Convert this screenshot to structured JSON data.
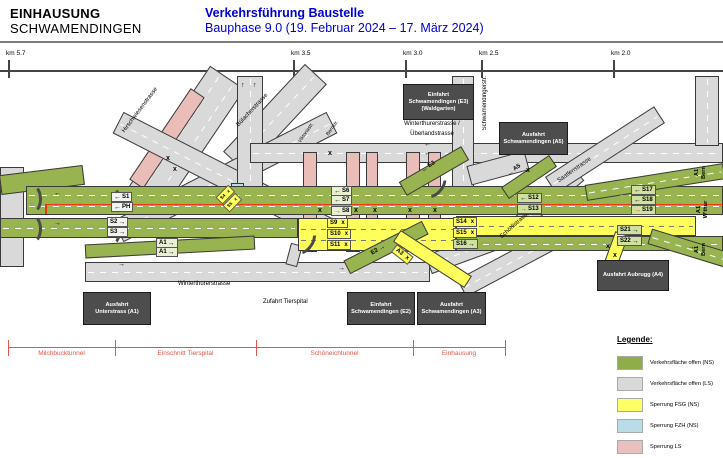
{
  "header": {
    "title_line1": "EINHAUSUNG",
    "title_line2": "SCHWAMENDINGEN",
    "subtitle_line1": "Verkehrsführung Baustelle",
    "subtitle_line2": "Bauphase 9.0 (19. Februar 2024 – 17. März 2024)",
    "accent_color": "#0000d2"
  },
  "km_scale": {
    "ticks": [
      {
        "label": "km 5.7",
        "x": 8
      },
      {
        "label": "km 3.5",
        "x": 293
      },
      {
        "label": "km 3.0",
        "x": 405
      },
      {
        "label": "km 2.5",
        "x": 481
      },
      {
        "label": "km 2.0",
        "x": 613
      }
    ]
  },
  "diagram": {
    "street_labels": [
      {
        "text": "Hirschwiesenstrasse",
        "x": 126,
        "y": 128,
        "rot": -53
      },
      {
        "text": "Bülacherstrasse",
        "x": 240,
        "y": 122,
        "rot": -47
      },
      {
        "text": "Viktoriastr.",
        "x": 302,
        "y": 138,
        "rot": -55,
        "fs": 5
      },
      {
        "text": "Bernstr.",
        "x": 330,
        "y": 131,
        "rot": -55,
        "fs": 5
      },
      {
        "text": "Winterthurerstrasse /",
        "x": 432,
        "y": 121,
        "rot": 0,
        "center": true
      },
      {
        "text": "Überlandstrasse",
        "x": 432,
        "y": 131,
        "rot": 0,
        "center": true
      },
      {
        "text": "Schörlistrasse",
        "x": 503,
        "y": 234,
        "rot": -42
      },
      {
        "text": "Saatlenstrasse",
        "x": 560,
        "y": 178,
        "rot": -35
      },
      {
        "text": "Winterthurerstrasse",
        "x": 178,
        "y": 281,
        "rot": 0
      },
      {
        "text": "Zufahrt Tierspital",
        "x": 263,
        "y": 299,
        "rot": 0
      }
    ],
    "vertical_street_label": {
      "text": "Schwamendingerstr.",
      "x": 482,
      "y": 76
    },
    "signal_chips": [
      {
        "t": "S1",
        "arrow": "left",
        "x": 111,
        "y": 192,
        "bg": "#f2f2ee"
      },
      {
        "t": "PH",
        "arrow": "left",
        "x": 111,
        "y": 202,
        "bg": "#f2f2ee"
      },
      {
        "t": "S2",
        "arrow": "right",
        "after": true,
        "x": 107,
        "y": 217,
        "bg": "#f2f2ee"
      },
      {
        "t": "S3",
        "arrow": "right",
        "after": true,
        "x": 107,
        "y": 227,
        "bg": "#f2f2ee"
      },
      {
        "t": "A1",
        "arrow": "right",
        "after": true,
        "x": 156,
        "y": 238,
        "bg": "#e8efd2"
      },
      {
        "t": "A1",
        "arrow": "right",
        "after": true,
        "x": 156,
        "y": 247,
        "bg": "#e8efd2"
      },
      {
        "t": "S6",
        "arrow": "left",
        "x": 331,
        "y": 186,
        "bg": "#e8efd2"
      },
      {
        "t": "S7",
        "arrow": "left",
        "x": 331,
        "y": 195,
        "bg": "#e8efd2"
      },
      {
        "t": "S8",
        "arrow": "rightred",
        "x": 331,
        "y": 206,
        "bg": "#e8efd2"
      },
      {
        "t": "S9",
        "suffix": "x",
        "x": 327,
        "y": 218,
        "bg": "#ffff5c"
      },
      {
        "t": "S10",
        "suffix": "x",
        "x": 327,
        "y": 229,
        "bg": "#ffff5c"
      },
      {
        "t": "S11",
        "suffix": "x",
        "x": 327,
        "y": 240,
        "bg": "#ffff5c"
      },
      {
        "t": "S14",
        "suffix": "x",
        "x": 453,
        "y": 217,
        "bg": "#ffff5c"
      },
      {
        "t": "S15",
        "suffix": "x",
        "x": 453,
        "y": 228,
        "bg": "#ffff5c"
      },
      {
        "t": "S16",
        "arrow": "right",
        "after": true,
        "x": 453,
        "y": 239,
        "bg": "#cfe0a0"
      },
      {
        "t": "S12",
        "arrow": "left",
        "x": 517,
        "y": 193,
        "bg": "#cfe0a0"
      },
      {
        "t": "S13",
        "arrow": "rightred",
        "x": 517,
        "y": 204,
        "bg": "#cfe0a0"
      },
      {
        "t": "S17",
        "arrow": "left",
        "x": 631,
        "y": 185,
        "bg": "#cfe0a0"
      },
      {
        "t": "S18",
        "arrow": "left",
        "x": 631,
        "y": 195,
        "bg": "#cfe0a0"
      },
      {
        "t": "S19",
        "arrow": "rightred",
        "x": 631,
        "y": 205,
        "bg": "#cfe0a0"
      },
      {
        "t": "S21",
        "arrow": "right",
        "after": true,
        "x": 617,
        "y": 225,
        "bg": "#cfe0a0"
      },
      {
        "t": "S22",
        "arrow": "right",
        "after": true,
        "x": 617,
        "y": 236,
        "bg": "#cfe0a0"
      },
      {
        "t": "E3",
        "arrow": "left",
        "x": 420,
        "y": 168,
        "bg": "none",
        "rot": -32
      },
      {
        "t": "A5",
        "arrow": "left",
        "x": 506,
        "y": 172,
        "bg": "none",
        "rot": -36
      },
      {
        "t": "E2",
        "arrow": "right",
        "after": true,
        "x": 370,
        "y": 251,
        "bg": "none",
        "rot": -33
      },
      {
        "t": "A3",
        "suffix": "x",
        "x": 394,
        "y": 243,
        "bg": "#ffff5c",
        "rot": 38
      },
      {
        "t": "S4",
        "suffix": "x",
        "x": 219,
        "y": 196,
        "bg": "#ffff5c",
        "rot": -45,
        "fs": 4.5
      },
      {
        "t": "S5",
        "suffix": "x",
        "x": 226,
        "y": 204,
        "bg": "#ffff5c",
        "rot": -45,
        "fs": 4.5
      }
    ],
    "closure_glyph": "x",
    "closure_marks": [
      {
        "x": 328,
        "y": 150
      },
      {
        "x": 318,
        "y": 207
      },
      {
        "x": 354,
        "y": 207
      },
      {
        "x": 373,
        "y": 207
      },
      {
        "x": 408,
        "y": 207
      },
      {
        "x": 433,
        "y": 207
      },
      {
        "x": 526,
        "y": 167
      },
      {
        "x": 166,
        "y": 155
      },
      {
        "x": 173,
        "y": 166
      },
      {
        "x": 606,
        "y": 243
      },
      {
        "x": 613,
        "y": 252
      }
    ],
    "lane_arrows": [
      {
        "g": "←",
        "x": 54,
        "y": 190
      },
      {
        "g": "→",
        "x": 54,
        "y": 220
      },
      {
        "g": "→",
        "x": 118,
        "y": 261
      },
      {
        "g": "→",
        "x": 338,
        "y": 265
      },
      {
        "g": "←",
        "x": 424,
        "y": 141
      },
      {
        "g": "←",
        "x": 424,
        "y": 150
      },
      {
        "g": "↑",
        "x": 241,
        "y": 82
      },
      {
        "g": "↑",
        "x": 253,
        "y": 82
      },
      {
        "g": "→",
        "x": 688,
        "y": 244
      }
    ],
    "gate_boxes": [
      {
        "lines": [
          "Einfahrt",
          "Schwamendingen (E3)",
          "(Waldgarten)"
        ],
        "x": 403,
        "y": 84,
        "w": 69,
        "h": 34
      },
      {
        "lines": [
          "Ausfahrt",
          "Schwamendingen (A5)"
        ],
        "x": 499,
        "y": 122,
        "w": 67,
        "h": 31
      },
      {
        "lines": [
          "Ausfahrt",
          "Unterstrass (A1)"
        ],
        "x": 83,
        "y": 292,
        "w": 66,
        "h": 31
      },
      {
        "lines": [
          "Einfahrt",
          "Schwamendingen (E2)"
        ],
        "x": 347,
        "y": 292,
        "w": 66,
        "h": 31
      },
      {
        "lines": [
          "Ausfahrt",
          "Schwamendingen (A3)"
        ],
        "x": 417,
        "y": 292,
        "w": 67,
        "h": 31
      },
      {
        "lines": [
          "Ausfahrt Aubrugg (A4)"
        ],
        "x": 597,
        "y": 260,
        "w": 70,
        "h": 29
      }
    ],
    "edge_labels": [
      {
        "l1": "A1",
        "l2": "Bern",
        "x": 694,
        "y": 166
      },
      {
        "l1": "A1",
        "l2": "W'thur",
        "x": 694,
        "y": 203
      },
      {
        "l1": "A1",
        "l2": "Bern",
        "x": 694,
        "y": 243
      }
    ]
  },
  "section_scale": {
    "color": "#e4554a",
    "tick_x": [
      8,
      115,
      256,
      413,
      505
    ],
    "labels": [
      "Milchbucktunnel",
      "Einschnitt Tierspital",
      "Schöneichtunnel",
      "Einhausung"
    ]
  },
  "legend": {
    "title": "Legende:",
    "items": [
      {
        "color": "#8fae4a",
        "label": "Verkehrsfläche offen (NS)"
      },
      {
        "color": "#d9d9d9",
        "label": "Verkehrsfläche offen (LS)"
      },
      {
        "color": "#ffff66",
        "label": "Sperrung FSG (NS)"
      },
      {
        "color": "#b8dde9",
        "label": "Sperrung FZH (NS)"
      },
      {
        "color": "#e9c0bc",
        "label": "Sperrung LS"
      }
    ]
  },
  "colors": {
    "green": "#98b450",
    "gray_road": "#d9d9d9",
    "yellow": "#ffff5c",
    "pink": "#eabdb8",
    "lightblue": "#b8dde9",
    "box_bg": "#4d4d4d",
    "red_route": "#e8380d",
    "scale_red": "#e4554a",
    "header_blue": "#0000d2"
  }
}
